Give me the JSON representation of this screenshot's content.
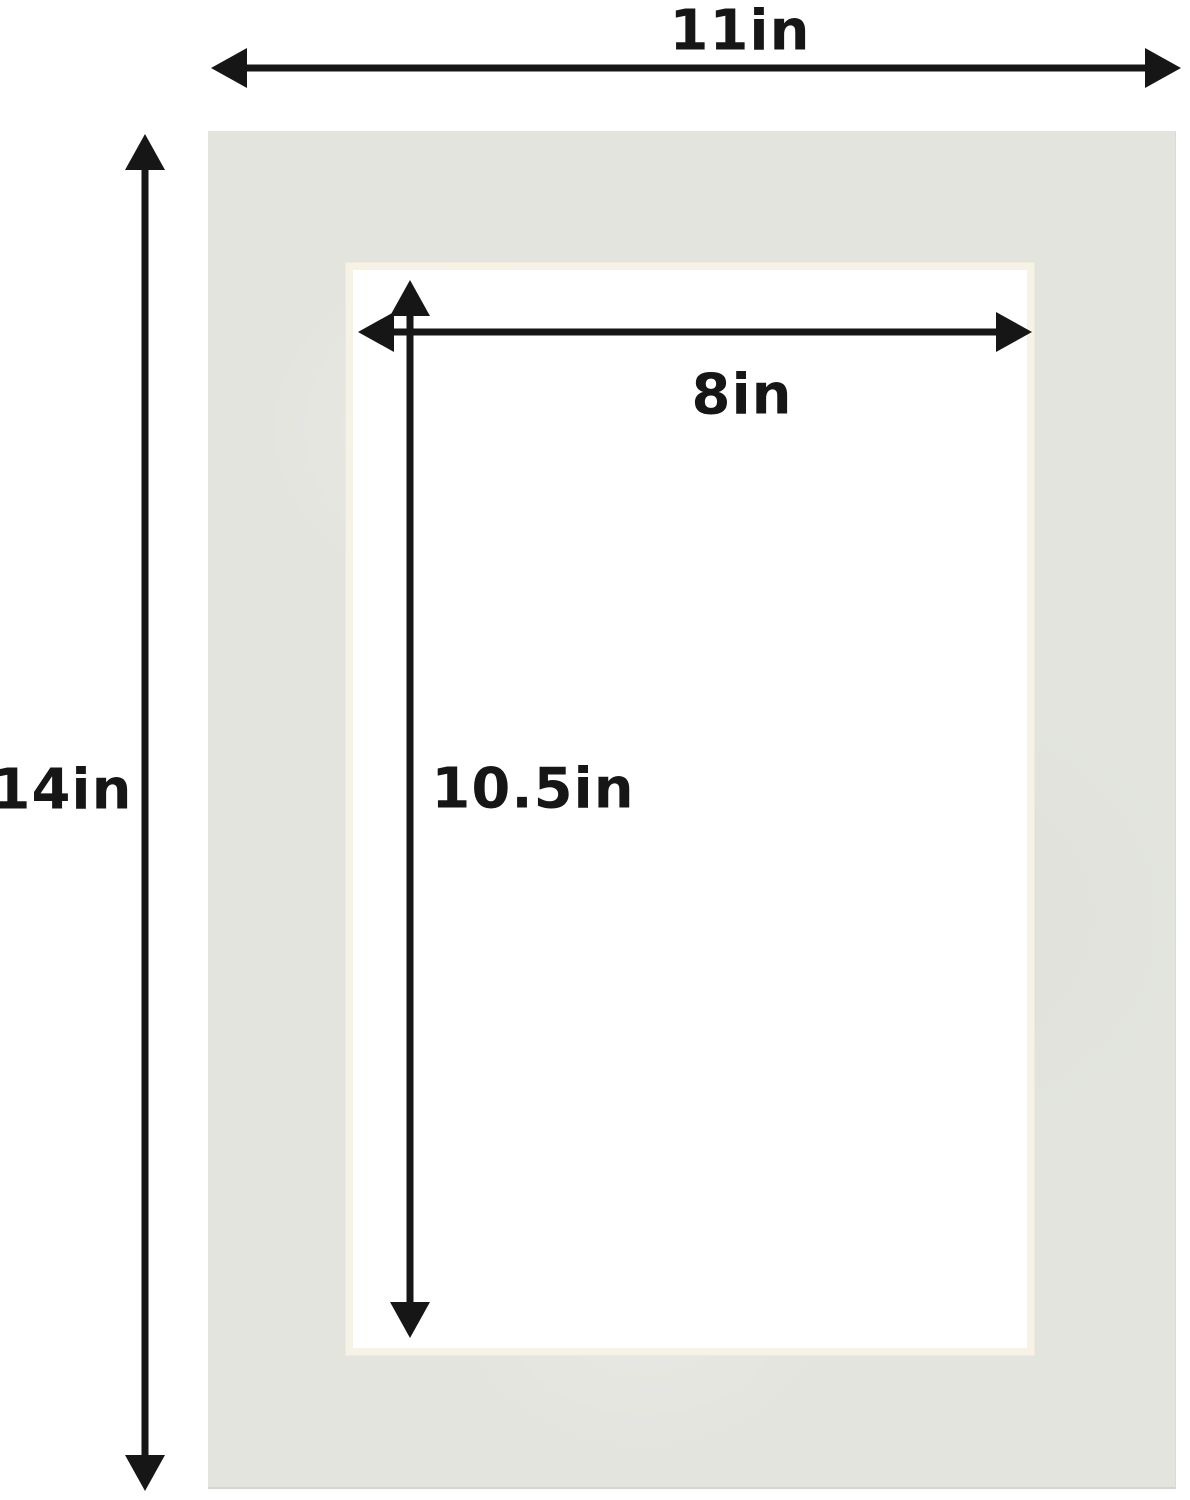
{
  "diagram": {
    "outer": {
      "width_label": "11in",
      "height_label": "14in"
    },
    "opening": {
      "width_label": "8in",
      "height_label": "10.5in"
    },
    "colors": {
      "background": "#ffffff",
      "mat": "#e3e4de",
      "bevel": "#f6f2e6",
      "opening": "#ffffff",
      "arrow": "#161616",
      "label_text": "#161616"
    }
  }
}
